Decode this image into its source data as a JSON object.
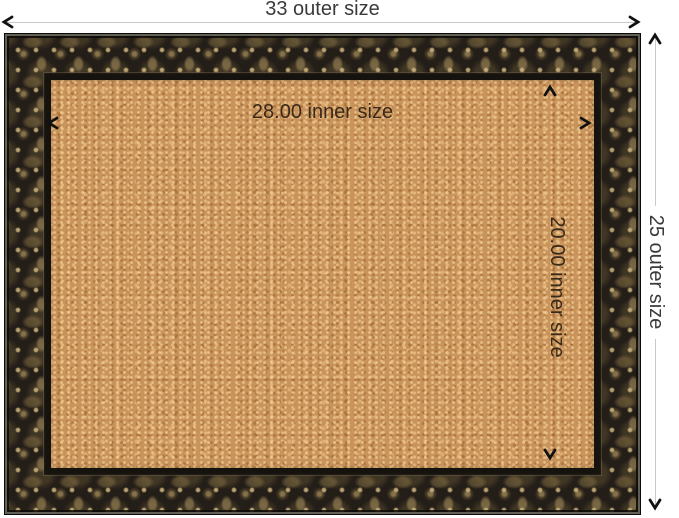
{
  "dimensions": {
    "outer_width_label": "33 outer size",
    "outer_height_label": "25 outer size",
    "inner_width_label": "28.00 inner size",
    "inner_height_label": "20.00 inner size"
  },
  "colors": {
    "background": "#ffffff",
    "dimension_line": "#c9c9c9",
    "arrow": "#111111",
    "outer_label_text": "#3a3a3a",
    "inner_label_text": "#3a2a1a",
    "cork_base": "#c9935c",
    "frame_base": "#241e18",
    "lip": "#16120e"
  }
}
